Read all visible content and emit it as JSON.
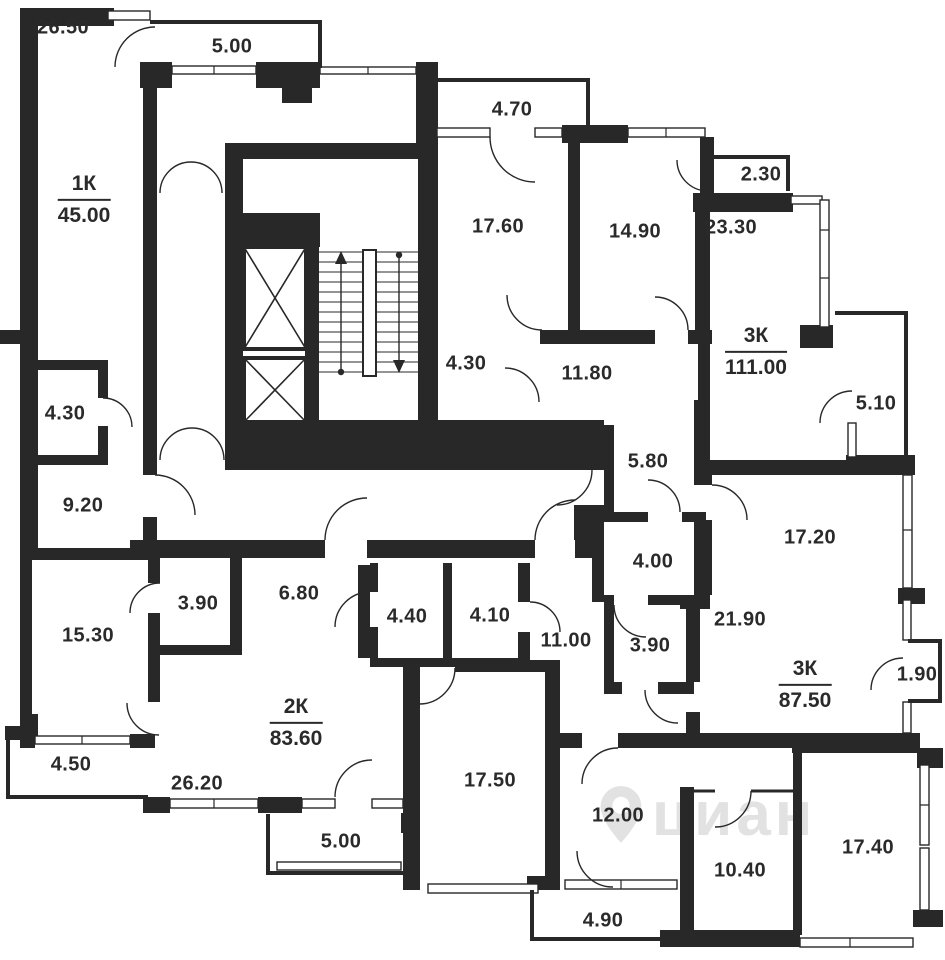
{
  "plan": {
    "watermark": "циан",
    "colors": {
      "wall": "#282828",
      "label": "#2a2a2a",
      "watermark": "#e2e2e2"
    },
    "apartments": [
      {
        "name": "1К",
        "area": "45.00"
      },
      {
        "name": "3К",
        "area": "111.00"
      },
      {
        "name": "2К",
        "area": "83.60"
      },
      {
        "name": "3К",
        "area": "87.50"
      }
    ],
    "rooms": [
      {
        "label": "26.50"
      },
      {
        "label": "5.00"
      },
      {
        "label": "4.70"
      },
      {
        "label": "2.30"
      },
      {
        "label": "17.60"
      },
      {
        "label": "14.90"
      },
      {
        "label": "23.30"
      },
      {
        "label": "4.30"
      },
      {
        "label": "11.80"
      },
      {
        "label": "5.10"
      },
      {
        "label": "4.30"
      },
      {
        "label": "9.20"
      },
      {
        "label": "5.80"
      },
      {
        "label": "4.00"
      },
      {
        "label": "17.20"
      },
      {
        "label": "3.90"
      },
      {
        "label": "6.80"
      },
      {
        "label": "4.40"
      },
      {
        "label": "4.10"
      },
      {
        "label": "11.00"
      },
      {
        "label": "3.90"
      },
      {
        "label": "21.90"
      },
      {
        "label": "15.30"
      },
      {
        "label": "1.90"
      },
      {
        "label": "4.50"
      },
      {
        "label": "26.20"
      },
      {
        "label": "5.00"
      },
      {
        "label": "17.50"
      },
      {
        "label": "12.00"
      },
      {
        "label": "4.90"
      },
      {
        "label": "10.40"
      },
      {
        "label": "17.40"
      }
    ]
  }
}
